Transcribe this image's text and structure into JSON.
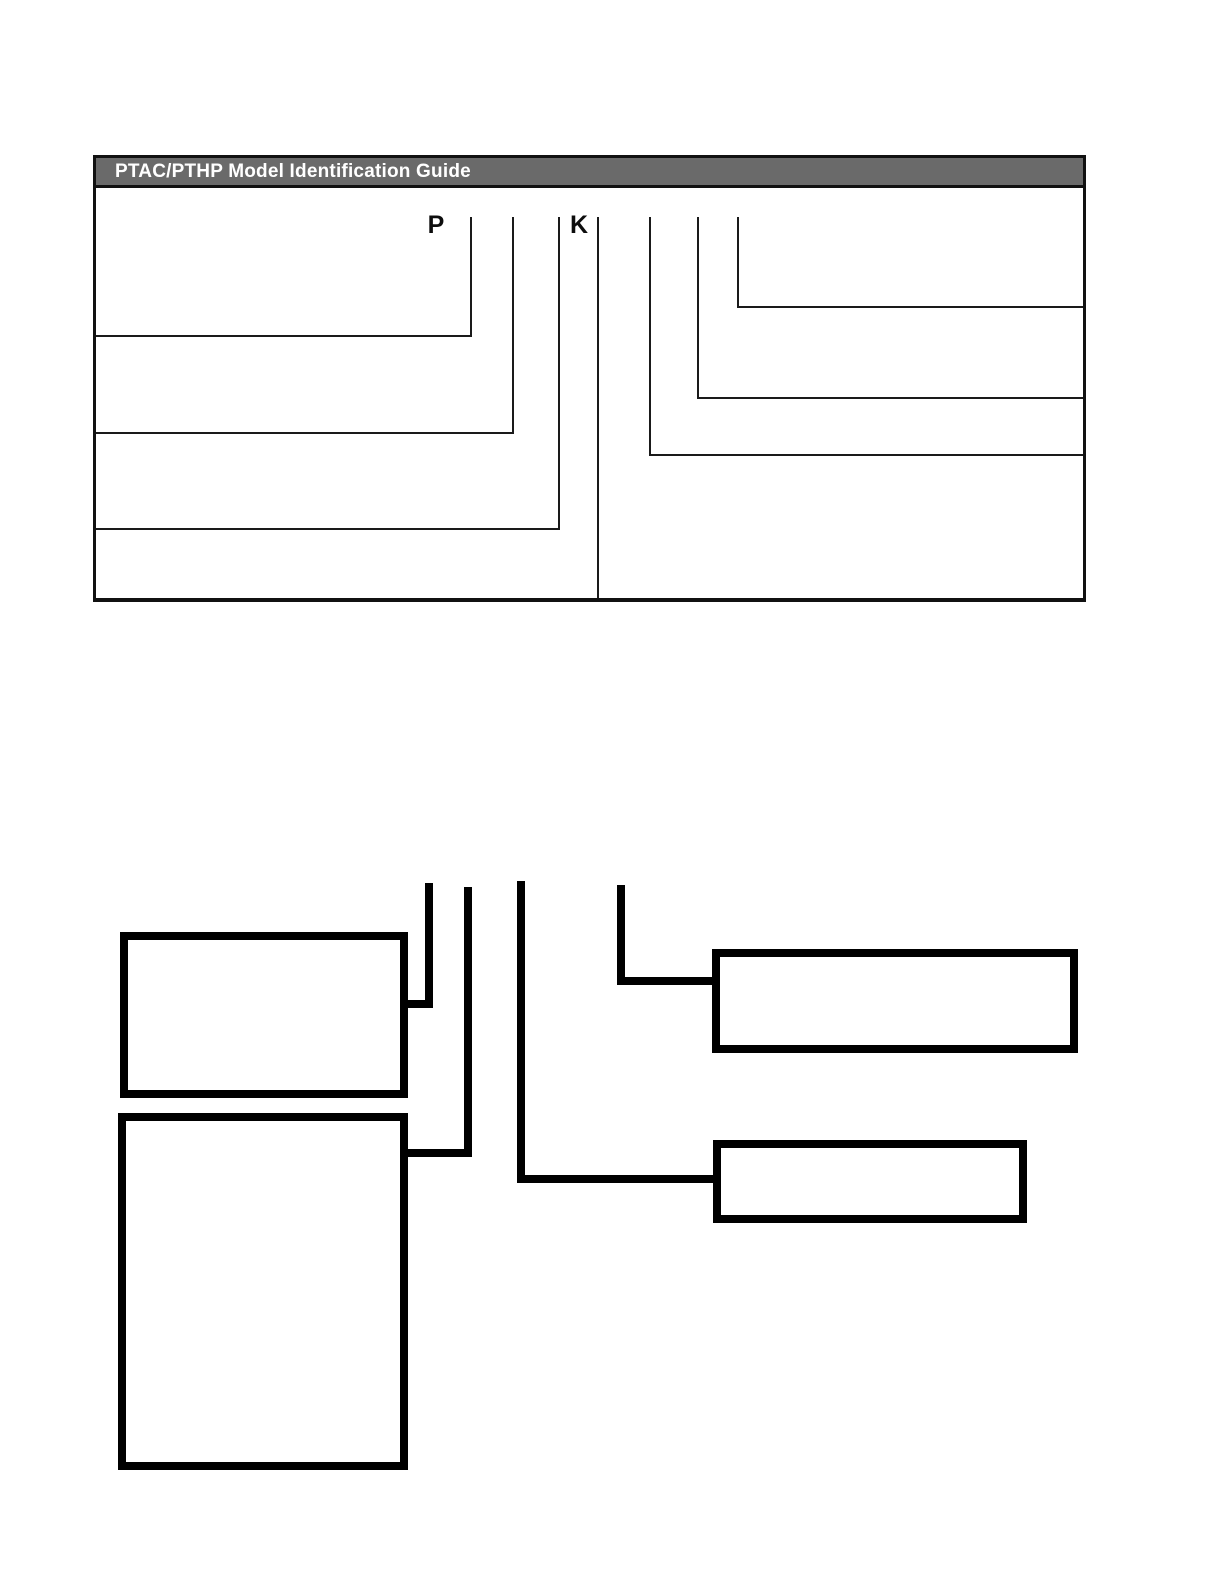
{
  "guide": {
    "title": "PTAC/PTHP Model Identification Guide",
    "model_letters": {
      "p": "P",
      "k": "K"
    },
    "colors": {
      "header_bg": "#6a6a6a",
      "header_text": "#ffffff",
      "panel_border": "#111111",
      "callout_line": "#1a1a1a"
    },
    "callout_lines": {
      "left_count": 3,
      "right_count": 3,
      "divider_count": 7
    }
  },
  "flowchart": {
    "colors": {
      "connector_line": "#000000",
      "box_border": "#000000",
      "box_fill": "#ffffff"
    },
    "boxes": [
      {
        "id": "top-left",
        "label": ""
      },
      {
        "id": "bottom-left",
        "label": ""
      },
      {
        "id": "top-right",
        "label": ""
      },
      {
        "id": "middle-right",
        "label": ""
      }
    ]
  }
}
